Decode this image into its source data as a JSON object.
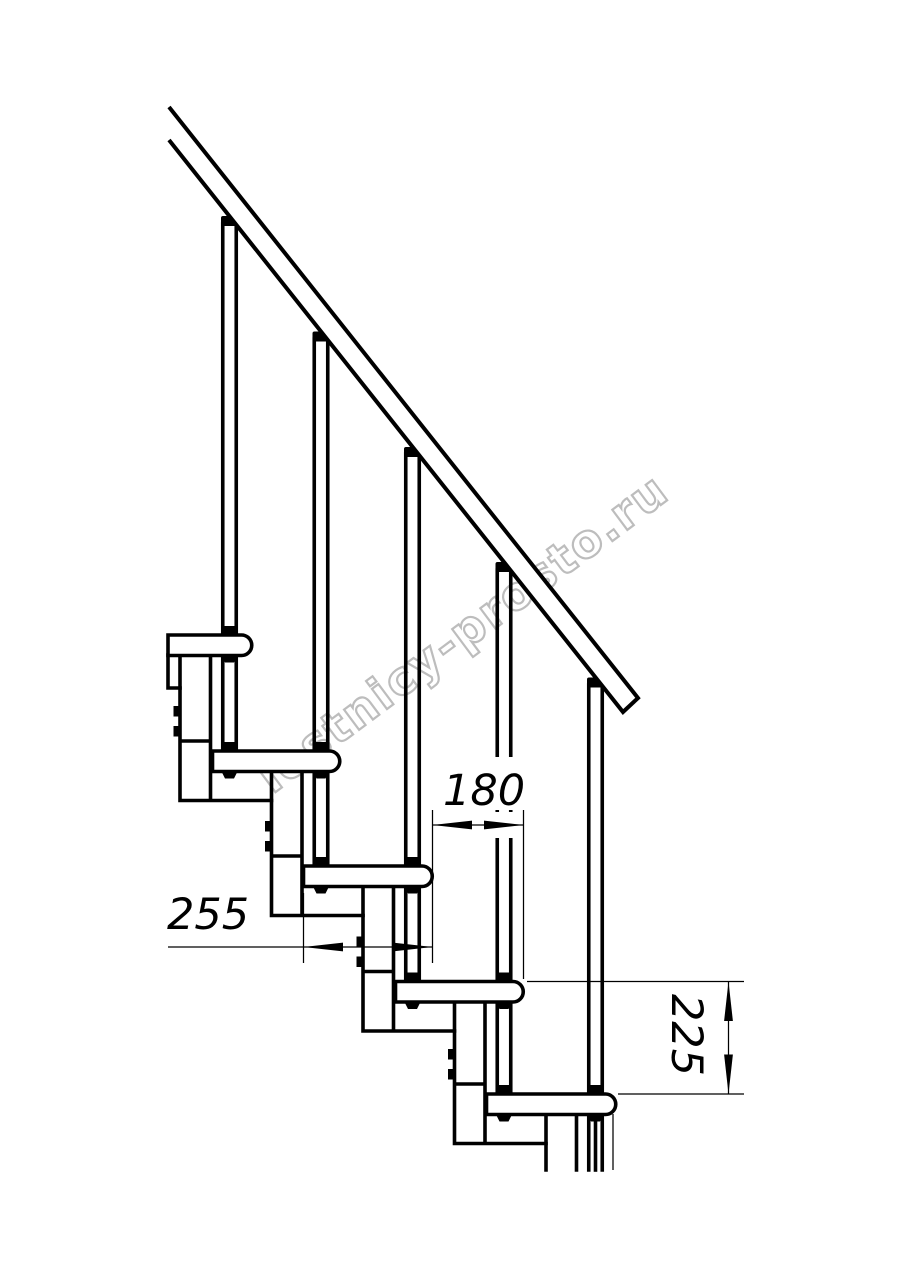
{
  "drawing": {
    "title": "modular-staircase-side-elevation",
    "watermark": {
      "text": "lestnicy-prosto.ru",
      "color": "#bdbdbd"
    },
    "dimensions": {
      "going": {
        "value": "180",
        "orientation": "horizontal"
      },
      "tread_depth": {
        "value": "255",
        "orientation": "horizontal"
      },
      "rise": {
        "value": "225",
        "orientation": "vertical"
      }
    },
    "colors": {
      "line": "#000000",
      "background": "#ffffff"
    }
  }
}
